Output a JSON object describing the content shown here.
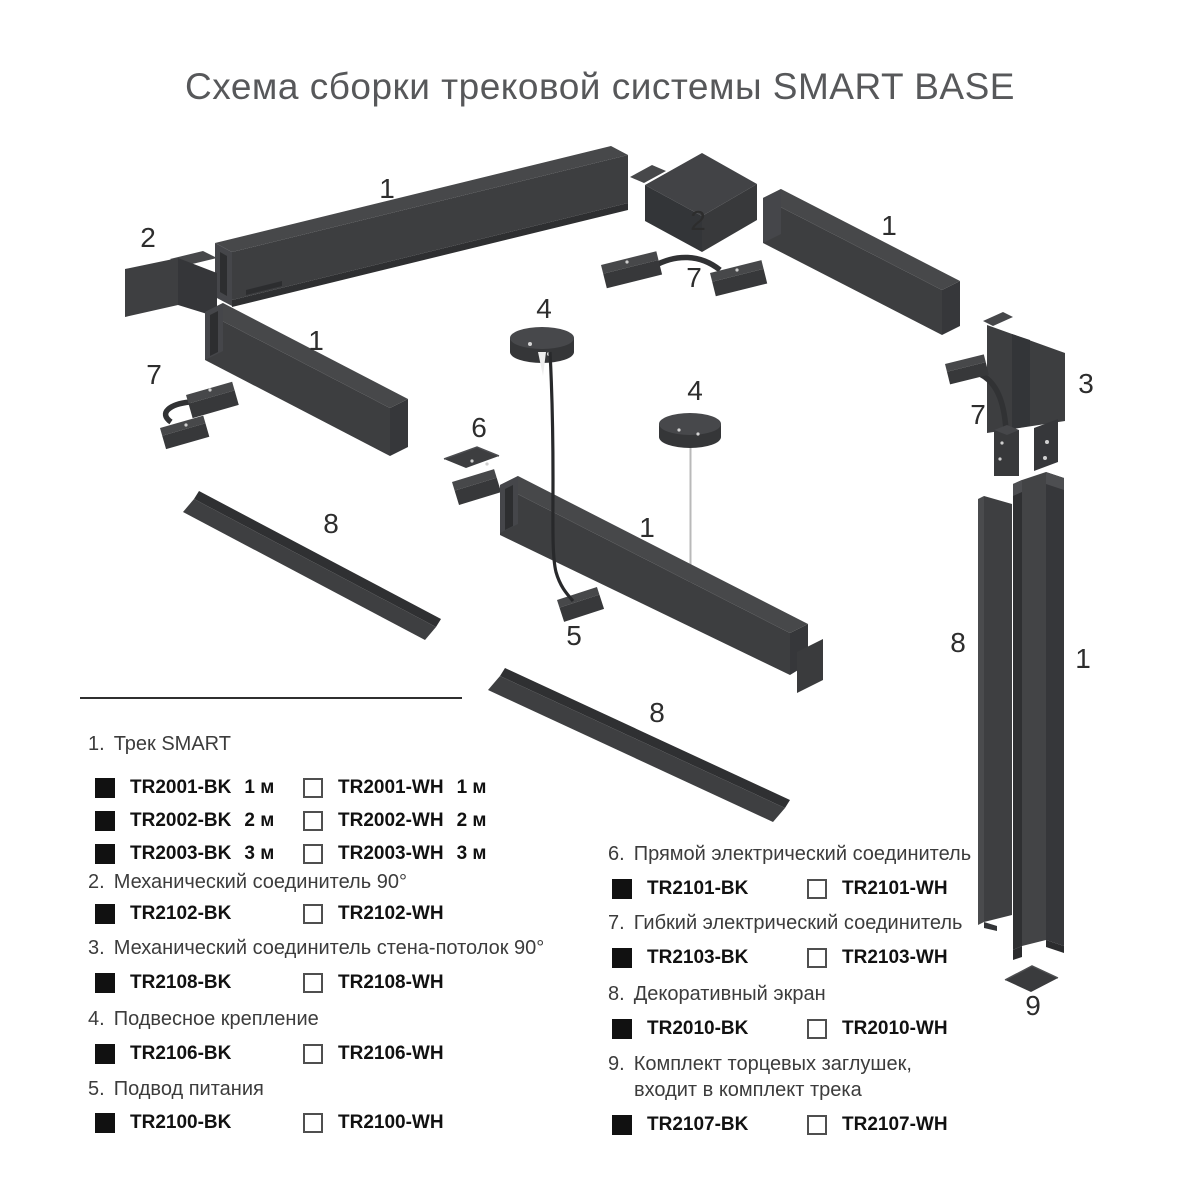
{
  "title": "Схема сборки трековой системы SMART BASE",
  "diagram": {
    "callouts": [
      {
        "id": "track-top-left",
        "text": "1"
      },
      {
        "id": "corner-left",
        "text": "2"
      },
      {
        "id": "flex-left",
        "text": "7"
      },
      {
        "id": "track-mid-left",
        "text": "1"
      },
      {
        "id": "pendant-mount-1",
        "text": "4"
      },
      {
        "id": "straight-connector",
        "text": "6"
      },
      {
        "id": "corner-top",
        "text": "2"
      },
      {
        "id": "flex-top",
        "text": "7"
      },
      {
        "id": "track-top-right",
        "text": "1"
      },
      {
        "id": "wall-ceiling",
        "text": "3"
      },
      {
        "id": "flex-right",
        "text": "7"
      },
      {
        "id": "pendant-mount-2",
        "text": "4"
      },
      {
        "id": "track-center",
        "text": "1"
      },
      {
        "id": "power-feed",
        "text": "5"
      },
      {
        "id": "screen-left",
        "text": "8"
      },
      {
        "id": "screen-bottom",
        "text": "8"
      },
      {
        "id": "screen-right",
        "text": "8"
      },
      {
        "id": "track-right",
        "text": "1"
      },
      {
        "id": "end-cap",
        "text": "9"
      }
    ]
  },
  "legend": {
    "left": [
      {
        "number": "1.",
        "label": "Трек SMART",
        "rows": [
          {
            "bk_code": "TR2001-BK",
            "bk_size": "1 м",
            "wh_code": "TR2001-WH",
            "wh_size": "1 м"
          },
          {
            "bk_code": "TR2002-BK",
            "bk_size": "2 м",
            "wh_code": "TR2002-WH",
            "wh_size": "2 м"
          },
          {
            "bk_code": "TR2003-BK",
            "bk_size": "3 м",
            "wh_code": "TR2003-WH",
            "wh_size": "3 м"
          }
        ]
      },
      {
        "number": "2.",
        "label": "Механический соединитель 90°",
        "rows": [
          {
            "bk_code": "TR2102-BK",
            "wh_code": "TR2102-WH"
          }
        ]
      },
      {
        "number": "3.",
        "label": "Механический соединитель стена-потолок 90°",
        "rows": [
          {
            "bk_code": "TR2108-BK",
            "wh_code": "TR2108-WH"
          }
        ]
      },
      {
        "number": "4.",
        "label": "Подвесное крепление",
        "rows": [
          {
            "bk_code": "TR2106-BK",
            "wh_code": "TR2106-WH"
          }
        ]
      },
      {
        "number": "5.",
        "label": "Подвод питания",
        "rows": [
          {
            "bk_code": "TR2100-BK",
            "wh_code": "TR2100-WH"
          }
        ]
      }
    ],
    "right": [
      {
        "number": "6.",
        "label": "Прямой электрический соединитель",
        "rows": [
          {
            "bk_code": "TR2101-BK",
            "wh_code": "TR2101-WH"
          }
        ]
      },
      {
        "number": "7.",
        "label": "Гибкий электрический соединитель",
        "rows": [
          {
            "bk_code": "TR2103-BK",
            "wh_code": "TR2103-WH"
          }
        ]
      },
      {
        "number": "8.",
        "label": "Декоративный экран",
        "rows": [
          {
            "bk_code": "TR2010-BK",
            "wh_code": "TR2010-WH"
          }
        ]
      },
      {
        "number": "9.",
        "label": "Комплект торцевых заглушек,",
        "label_line2": "входит в комплект трека",
        "rows": [
          {
            "bk_code": "TR2107-BK",
            "wh_code": "TR2107-WH"
          }
        ]
      }
    ]
  },
  "colors": {
    "part_face": "#3d3e40",
    "part_top": "#47484a",
    "part_dark": "#333538",
    "part_deepest": "#2d2e30",
    "cable": "#28292b",
    "suspension_wire": "#b9b9b9",
    "title_text": "#57585a",
    "legend_text": "#3c3c3c",
    "code_text": "#111111",
    "swatch_black": "#111111",
    "swatch_white": "#ffffff"
  }
}
